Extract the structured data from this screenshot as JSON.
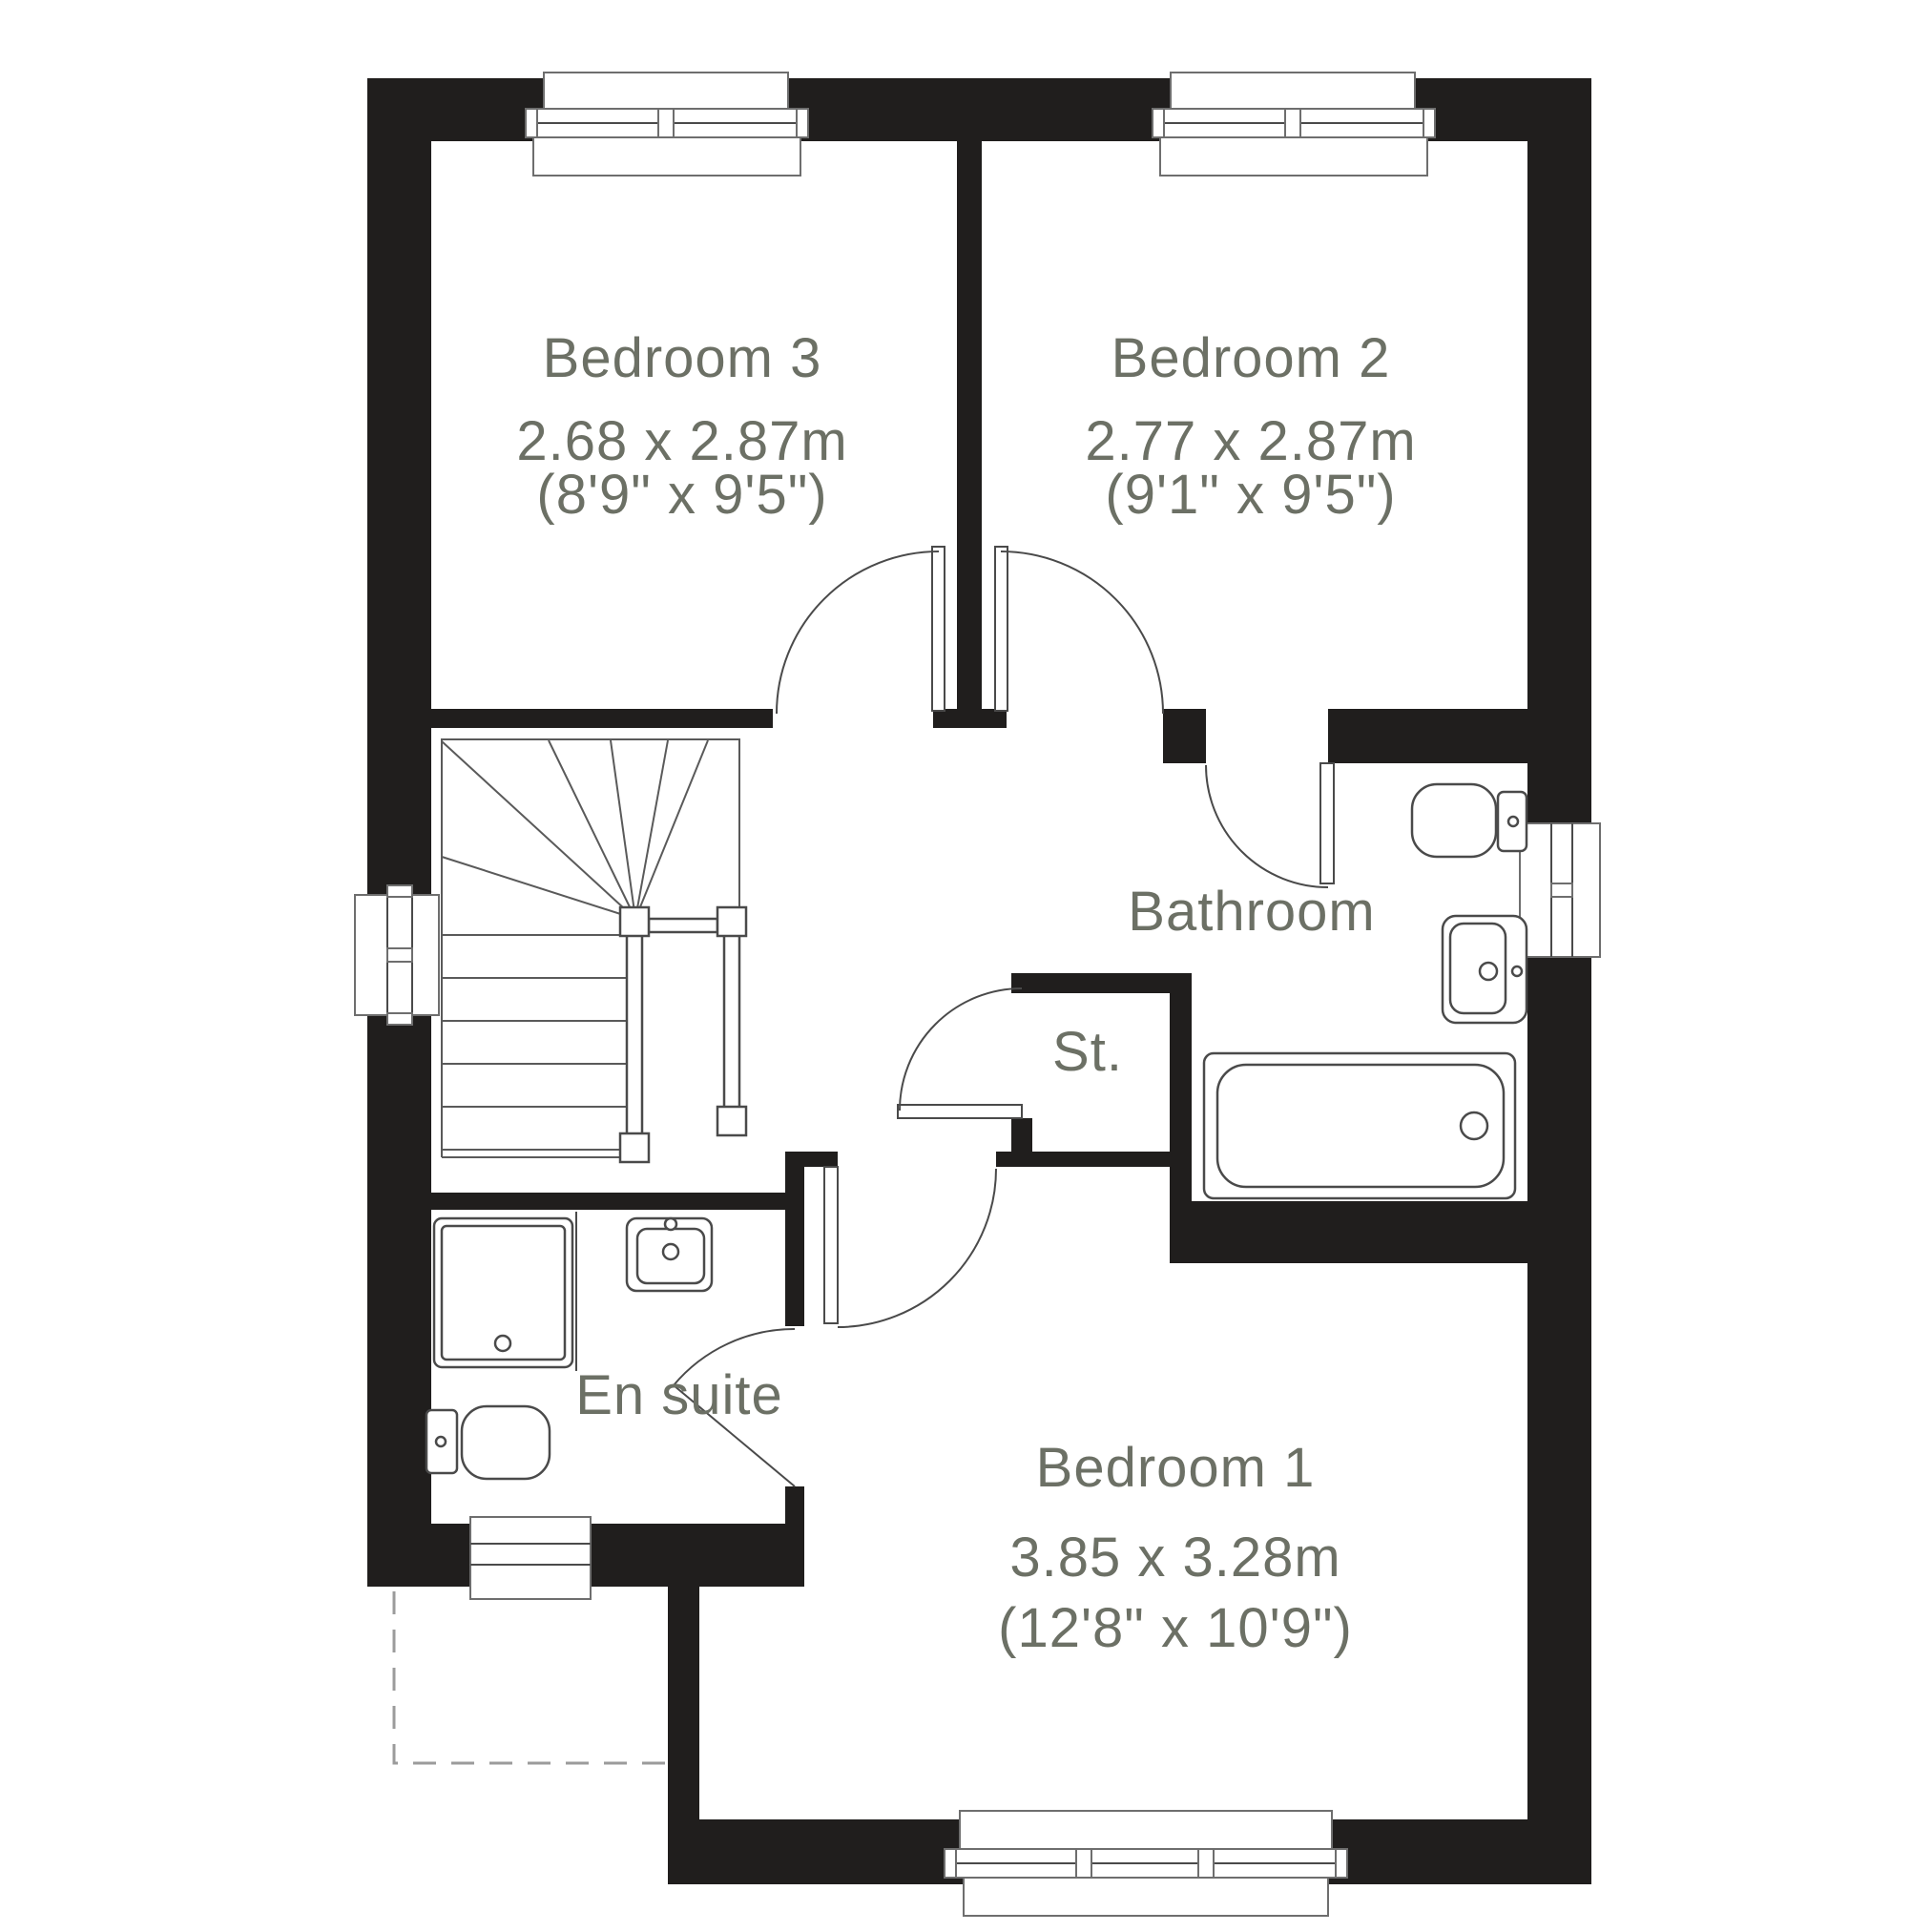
{
  "plan": {
    "type": "floor-plan",
    "colors": {
      "wall": "#201e1d",
      "label_text": "#6c7065",
      "fixture_line": "#4a4a4a",
      "dashed_outline": "#9b9b9b",
      "background": "#ffffff"
    },
    "rooms": {
      "bedroom3": {
        "name": "Bedroom 3",
        "metric": "2.68 x 2.87m",
        "imperial": "(8'9\" x 9'5\")"
      },
      "bedroom2": {
        "name": "Bedroom 2",
        "metric": "2.77 x 2.87m",
        "imperial": "(9'1\" x 9'5\")"
      },
      "bedroom1": {
        "name": "Bedroom 1",
        "metric": "3.85 x 3.28m",
        "imperial": "(12'8\" x 10'9\")"
      },
      "bathroom": {
        "name": "Bathroom"
      },
      "storage": {
        "name": "St."
      },
      "ensuite": {
        "name": "En suite"
      }
    },
    "features": [
      "staircase-with-winders",
      "bath",
      "bathroom-toilet",
      "bathroom-sink",
      "ensuite-shower",
      "ensuite-sink",
      "ensuite-toilet",
      "window-bedroom3",
      "window-bedroom2",
      "window-bedroom1",
      "window-stairs",
      "window-bathroom",
      "window-ensuite",
      "dashed-roof-outline"
    ]
  }
}
